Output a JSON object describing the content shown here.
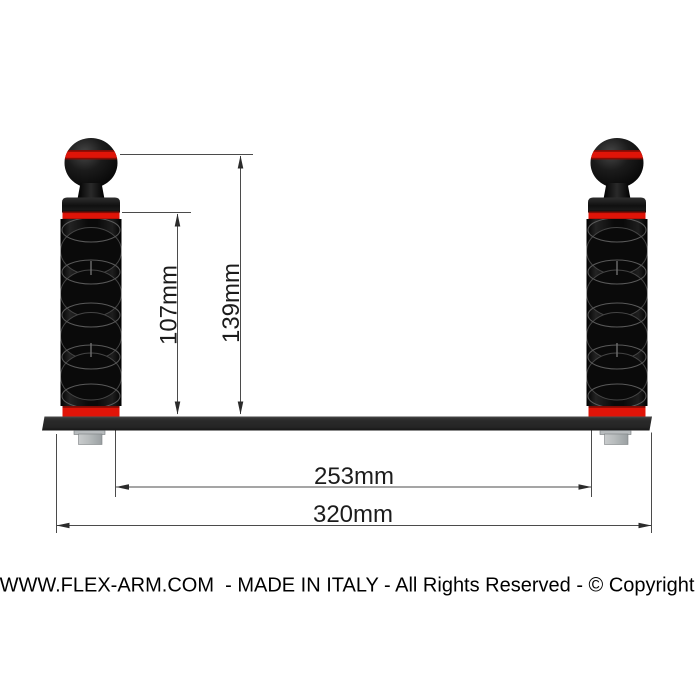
{
  "dimensions": {
    "arm_height_label": "107mm",
    "ball_height_label": "139mm",
    "inner_span_label": "253mm",
    "overall_span_label": "320mm"
  },
  "footer": {
    "text": "WWW.FLEX-ARM.COM  - MADE IN ITALY - All Rights Reserved - © Copyright"
  },
  "colors": {
    "accent_red": "#e01408",
    "arm_black": "#0d0d0d",
    "tray_dark": "#2b2b2b",
    "bolt_gray": "#b7bbbd",
    "dimension_line": "#4b4b4b",
    "text": "#1c1c1c",
    "background": "#ffffff"
  }
}
